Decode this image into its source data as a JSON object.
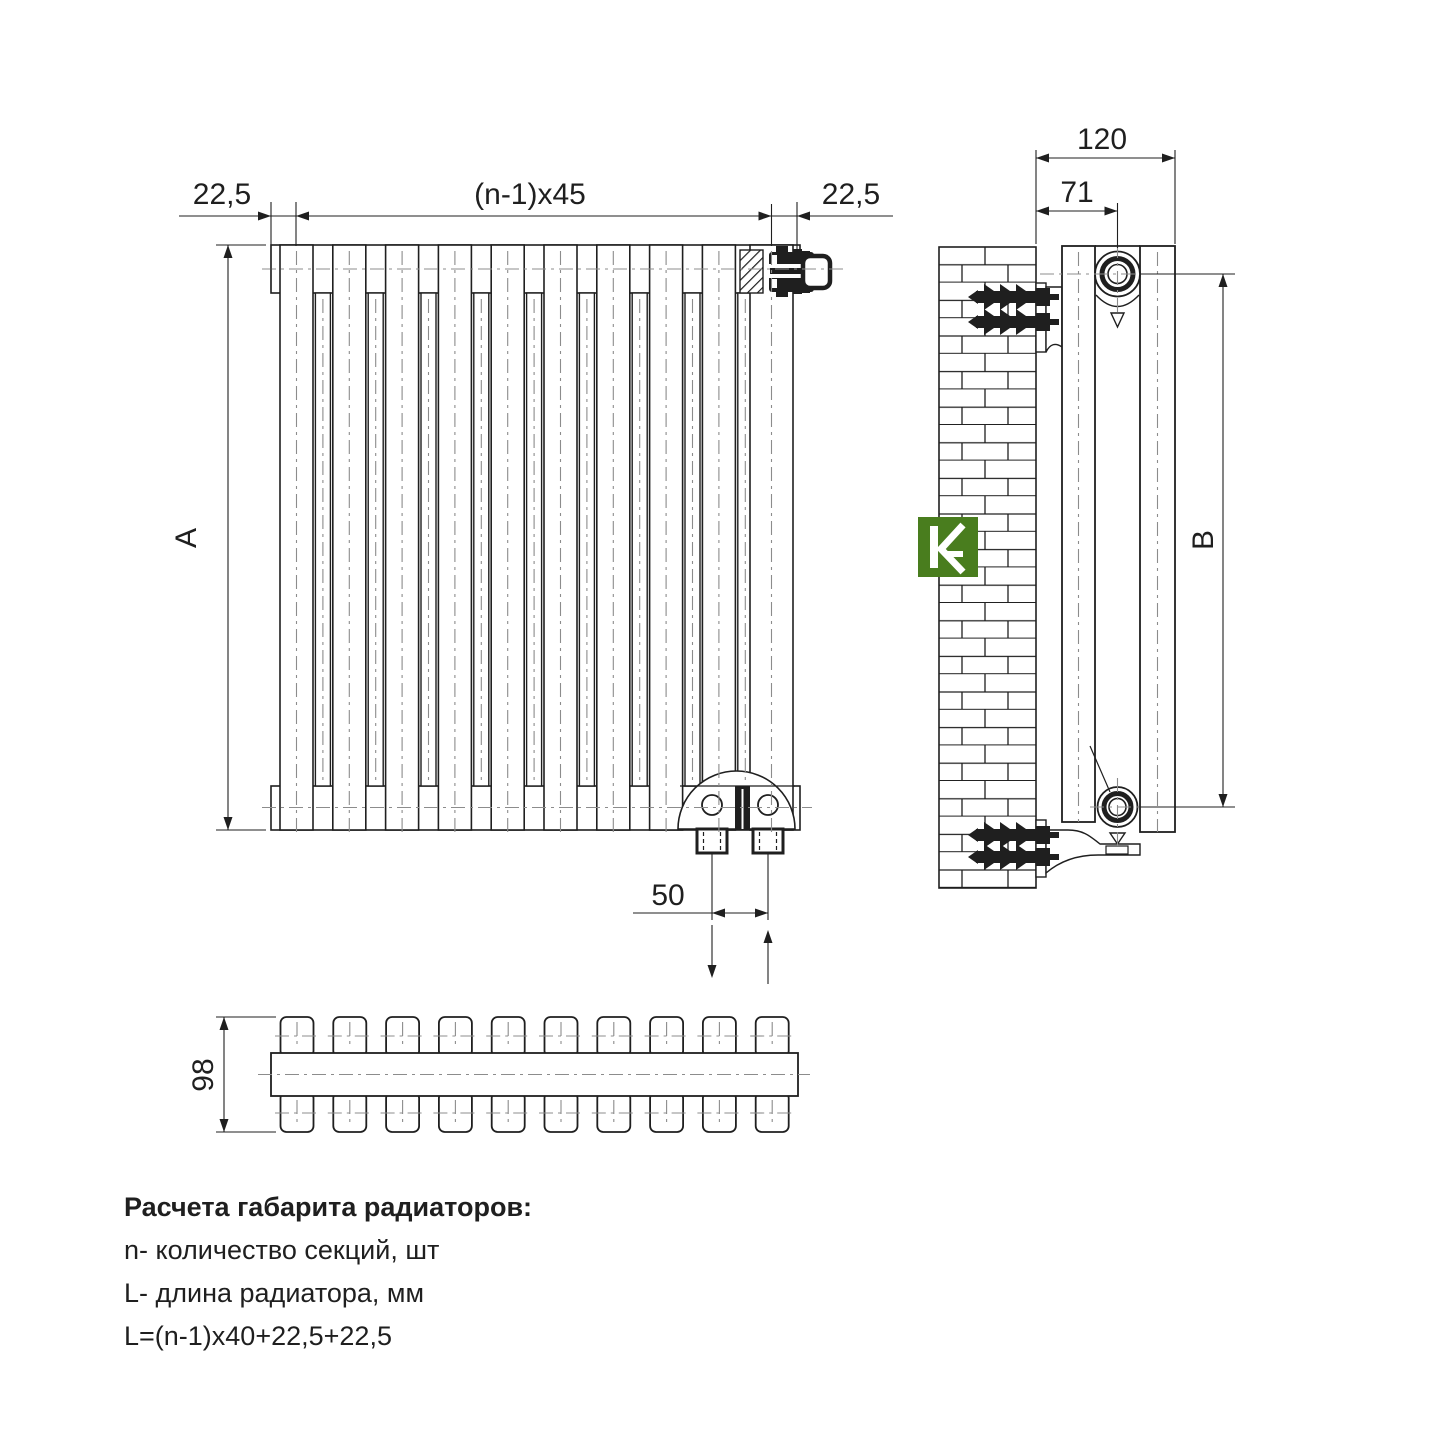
{
  "page": {
    "background": "#ffffff",
    "ink": "#1f1f1f",
    "centerline_color": "#8c8c8c"
  },
  "logo": {
    "name": "kvant-brand-logo",
    "color": "#497d1e",
    "glyph_color": "#ffffff"
  },
  "front_view": {
    "label_left_margin": "22,5",
    "label_section_pitch": "(n-1)x45",
    "label_right_margin": "22,5",
    "label_height": "A",
    "label_connection_spacing": "50"
  },
  "side_view": {
    "label_depth": "120",
    "label_axis_offset": "71",
    "label_mount_height": "B"
  },
  "top_view": {
    "label_depth": "98"
  },
  "notes": {
    "title": "Расчета габарита радиаторов:",
    "line_sections": "n- количество секций, шт",
    "line_length": "L- длина радиатора, мм",
    "line_formula": "L=(n-1)x40+22,5+22,5"
  }
}
